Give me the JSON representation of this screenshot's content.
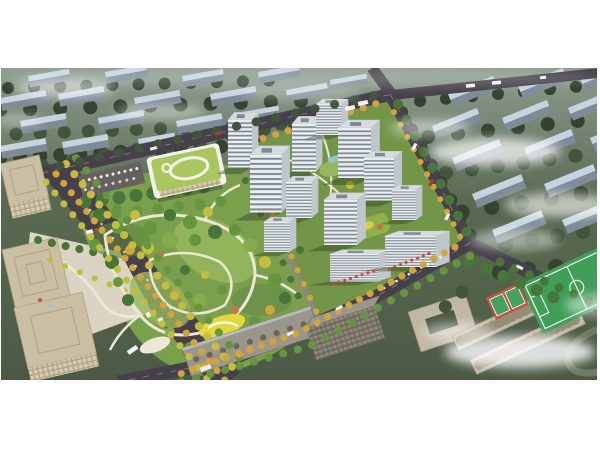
{
  "scene": {
    "description": "Aerial architectural rendering of a residential community master plan: central landscaped park with autumn trees and winding paths, cluster of white high-rise apartment towers around green courtyards, kindergarten with green roof and rooftop oval track, tree-lined boulevard, tan office towers at left, existing gray apartment slabs to the south, school campus with green sports field and red courts at bottom right, hazy rows of background housing blocks under drifting white clouds"
  },
  "legend": [
    {
      "id": "background-cityscape",
      "label": "Hazy background housing blocks"
    },
    {
      "id": "road-network",
      "label": "Perimeter roads"
    },
    {
      "id": "boulevard",
      "label": "Tree-lined boulevard"
    },
    {
      "id": "central-park",
      "label": "Central landscaped park"
    },
    {
      "id": "playground",
      "label": "Yellow playground area"
    },
    {
      "id": "kindergarten-building",
      "label": "Kindergarten with green roof"
    },
    {
      "id": "residential-cluster",
      "label": "White residential towers"
    },
    {
      "id": "retail-podium",
      "label": "Retail podium with awnings"
    },
    {
      "id": "office-towers-left",
      "label": "Office towers"
    },
    {
      "id": "existing-slabs-south",
      "label": "Existing apartment slabs"
    },
    {
      "id": "school-campus",
      "label": "School campus"
    },
    {
      "id": "sports-field",
      "label": "Soccer field"
    },
    {
      "id": "basketball-courts",
      "label": "Basketball courts"
    },
    {
      "id": "clouds-overlay",
      "label": "Drifting clouds"
    }
  ],
  "palette": {
    "canvas": "#ffffff",
    "bg-haze": "#8d9c8f",
    "bg-ground": "#5a6a52",
    "bg-deep": "#4c5a45",
    "bg-tree-dark": "#34422f",
    "bg-tree-mid": "#42543c",
    "slab-roof": "#c7d4df",
    "slab-face": "#7f8b96",
    "road": "#46404a",
    "road-line": "#d8d6d2",
    "sidewalk": "#8d8780",
    "parking": "#66605f",
    "park-base": "#7aa04e",
    "park-light": "#95b75e",
    "park-dark": "#5d8540",
    "courtyard-green": "#729548",
    "path-cream": "#ece7d6",
    "playground": "#e3d83e",
    "tree-dark": "#47753a",
    "tree-mid": "#669540",
    "tree-light": "#86ad4d",
    "tree-yellow": "#c6bd3f",
    "tree-gold": "#d2a43c",
    "tree-orange": "#c07a3c",
    "kg-roof": "#a9c65f",
    "kg-white": "#f3f2ec",
    "tower-wall": "#eceff1",
    "tower-win": "#7f8a93",
    "tower-roof": "#d6dbde",
    "tower-side": "#bfc7cd",
    "shadow": "rgba(40,55,35,0.38)",
    "podium-green": "#8fae4c",
    "podium-yellow": "#d8cf3e",
    "office-wall": "#d5caae",
    "office-line": "#b0a384",
    "office-roof": "#cabfa2",
    "plaza": "#dbd4c2",
    "grayslab-wall": "#8b857a",
    "grayslab-win": "#6b655a",
    "grayslab-roof": "#9b968c",
    "school-wall": "#c0b8a4",
    "school-line": "#958d79",
    "field-green": "#3f9e58",
    "field-line": "#e9f2ea",
    "court-red": "#c05742",
    "court-green": "#48a05f",
    "awning-red": "#c4473c",
    "car-white": "#f2f2f2",
    "car-red": "#b23a32",
    "pool-teal": "#8fc9c2",
    "track-gray": "#6e7a64",
    "fog-white": "#ffffff"
  }
}
